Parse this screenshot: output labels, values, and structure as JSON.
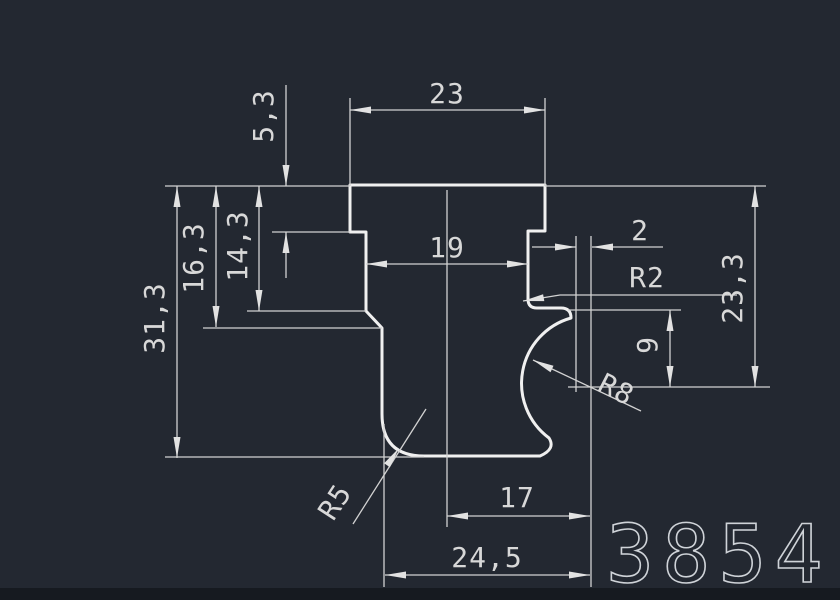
{
  "drawing": {
    "type": "cad-profile-section",
    "part_number": "3854"
  },
  "colors": {
    "background": "#232831",
    "profile_line": "#f0f0f0",
    "dimension_line": "#d2d2d2",
    "text": "#d8d8d8",
    "bottom_edge": "#161a20"
  },
  "dimensions": {
    "top_width": "23",
    "flange_height": "5,3",
    "inner_width": "19",
    "notch_offset": "2",
    "notch_radius": "R2",
    "left_step_depth": "14,3",
    "left_step_height": "16,3",
    "total_height": "31,3",
    "right_height": "23,3",
    "groove_height": "9",
    "groove_radius": "R8",
    "foot_radius": "R5",
    "bottom_inner_width": "17",
    "bottom_width": "24,5"
  }
}
